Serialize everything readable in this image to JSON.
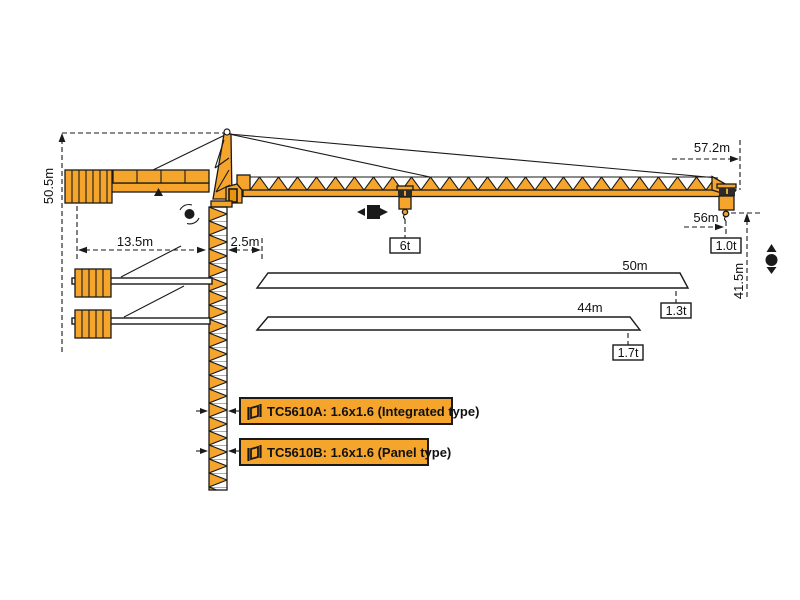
{
  "dimensions": {
    "total_height": "50.5m",
    "counter_jib_length": "13.5m",
    "rear_clearance": "2.5m",
    "max_radius": "57.2m",
    "tip_hook_radius": "56m",
    "hoist_height": "41.5m"
  },
  "loads": {
    "max_load": "6t",
    "tip_load": "1.0t"
  },
  "jib_variants": [
    {
      "length": "50m",
      "tip_load": "1.3t"
    },
    {
      "length": "44m",
      "tip_load": "1.7t"
    }
  ],
  "mast_sections": [
    {
      "label": "TC5610A:  1.6x1.6  (Integrated type)"
    },
    {
      "label": "TC5610B:  1.6x1.6  (Panel type)"
    }
  ],
  "colors": {
    "crane_orange": "#F5A42C",
    "line_black": "#1A1A1A",
    "background": "#FFFFFF"
  }
}
